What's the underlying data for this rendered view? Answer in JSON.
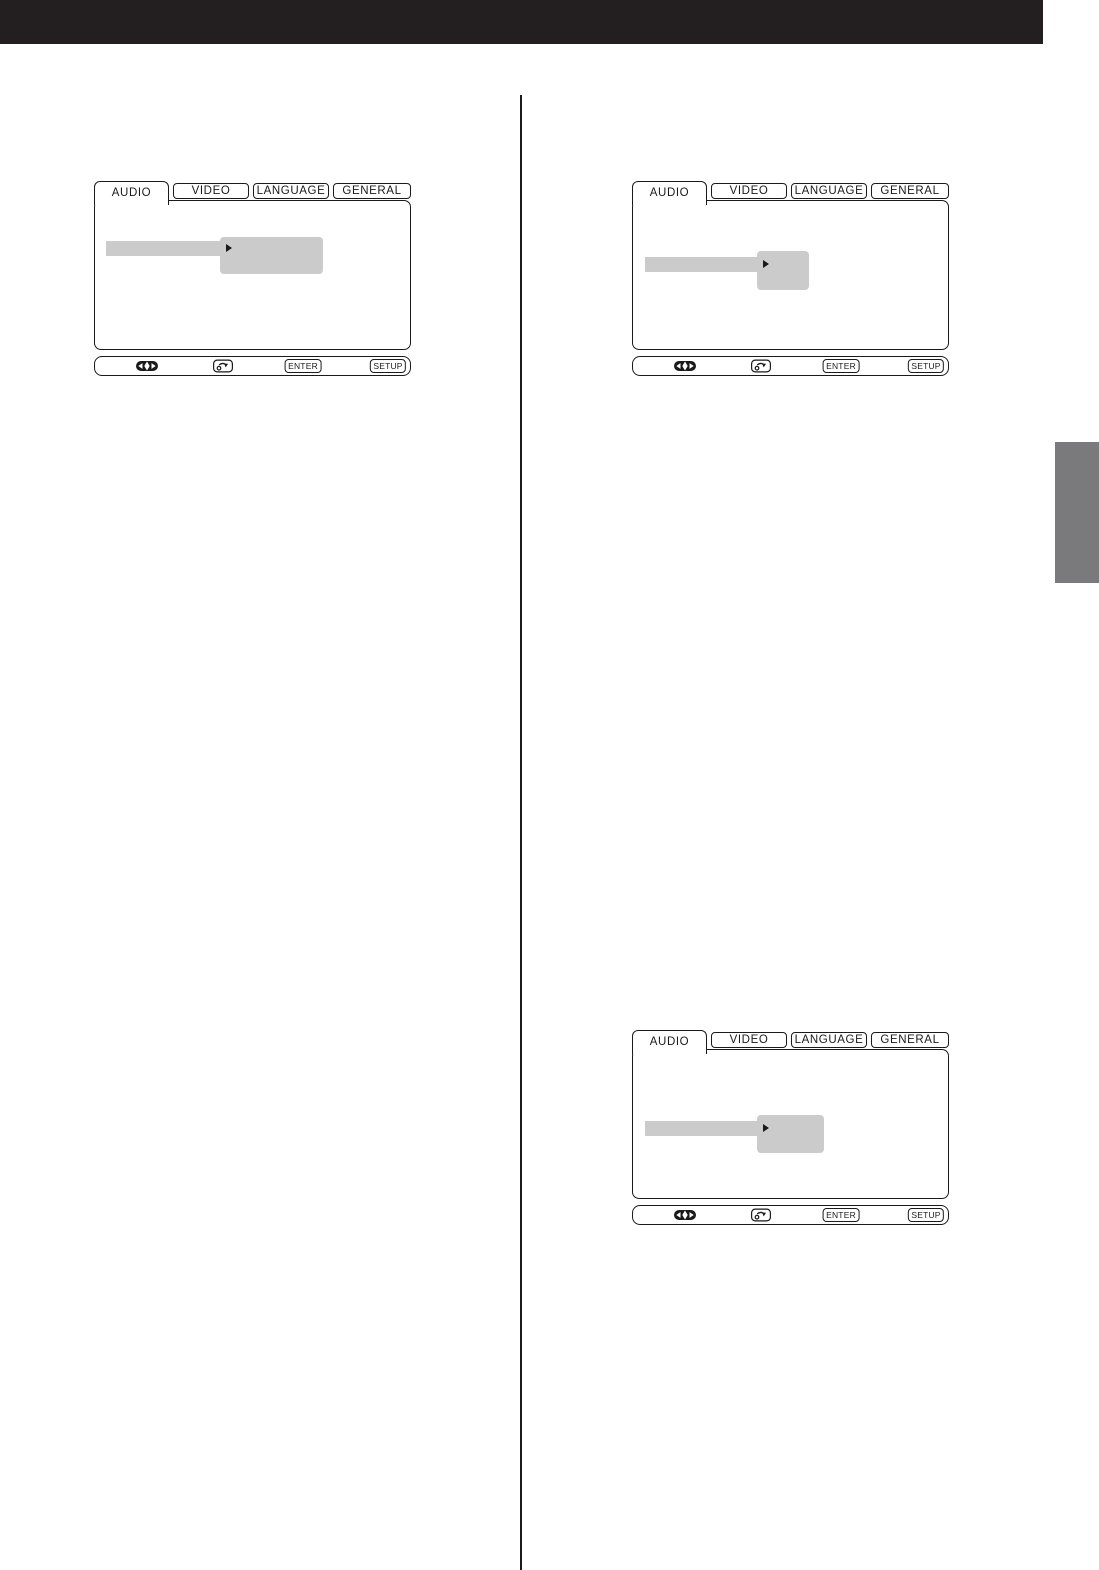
{
  "colors": {
    "ink": "#1a1a1a",
    "header_black": "#231f20",
    "highlight_gray": "#cbcbcb",
    "side_tab_gray": "#7a7a7c",
    "paper_white": "#ffffff"
  },
  "page": {
    "header_bar": "top-black-banner",
    "side_marker": "chapter-edge-tab",
    "divider": "two-column-rule"
  },
  "menu": {
    "active_tab": "AUDIO",
    "tabs": [
      "AUDIO",
      "VIDEO",
      "LANGUAGE",
      "GENERAL"
    ],
    "selected_item_style": "gray-highlight-bar",
    "popup_style": "gray-option-box",
    "icons": {
      "popup_arrow": "right-triangle-icon",
      "nav_pad": "four-way-arrow-pad-icon",
      "return": "return-curved-arrow-icon"
    },
    "controls": {
      "enter_label": "ENTER",
      "setup_label": "SETUP"
    }
  }
}
